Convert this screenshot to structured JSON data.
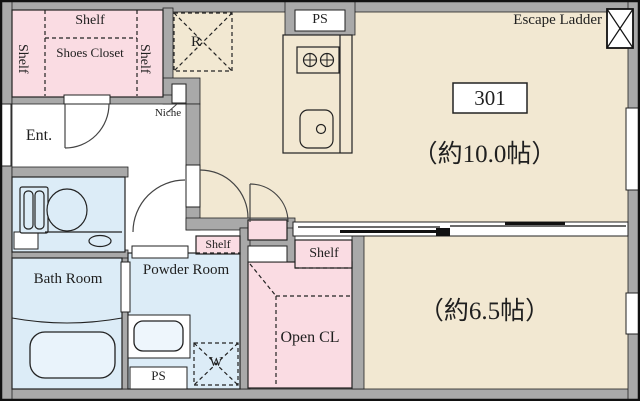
{
  "plan_title": "Apartment floor plan",
  "colors": {
    "floor_beige": "#f2e8d2",
    "closet_pink": "#fadce3",
    "wet_blue": "#dcecf7",
    "tub_fill": "#e9f3fb",
    "wall_gray": "#a9a9a9",
    "line": "#222222"
  },
  "unit": {
    "room_number": "301",
    "escape_ladder_label": "Escape Ladder"
  },
  "rooms": {
    "living": {
      "label": "（約10.0帖）"
    },
    "bedroom": {
      "label": "（約6.5帖）"
    },
    "entrance": {
      "label": "Ent."
    },
    "bath": {
      "label": "Bath Room"
    },
    "powder": {
      "label": "Powder Room"
    },
    "open_closet": {
      "label": "Open CL"
    },
    "shoes_closet": {
      "label": "Shoes Closet"
    }
  },
  "fixtures": {
    "refrigerator_space": "R",
    "washer_space": "W",
    "niche": "Niche",
    "ps_top": "PS",
    "ps_bottom": "PS"
  },
  "shelves": {
    "closet_top": "Shelf",
    "closet_left": "Shelf",
    "closet_right": "Shelf",
    "powder": "Shelf",
    "open_closet": "Shelf"
  }
}
